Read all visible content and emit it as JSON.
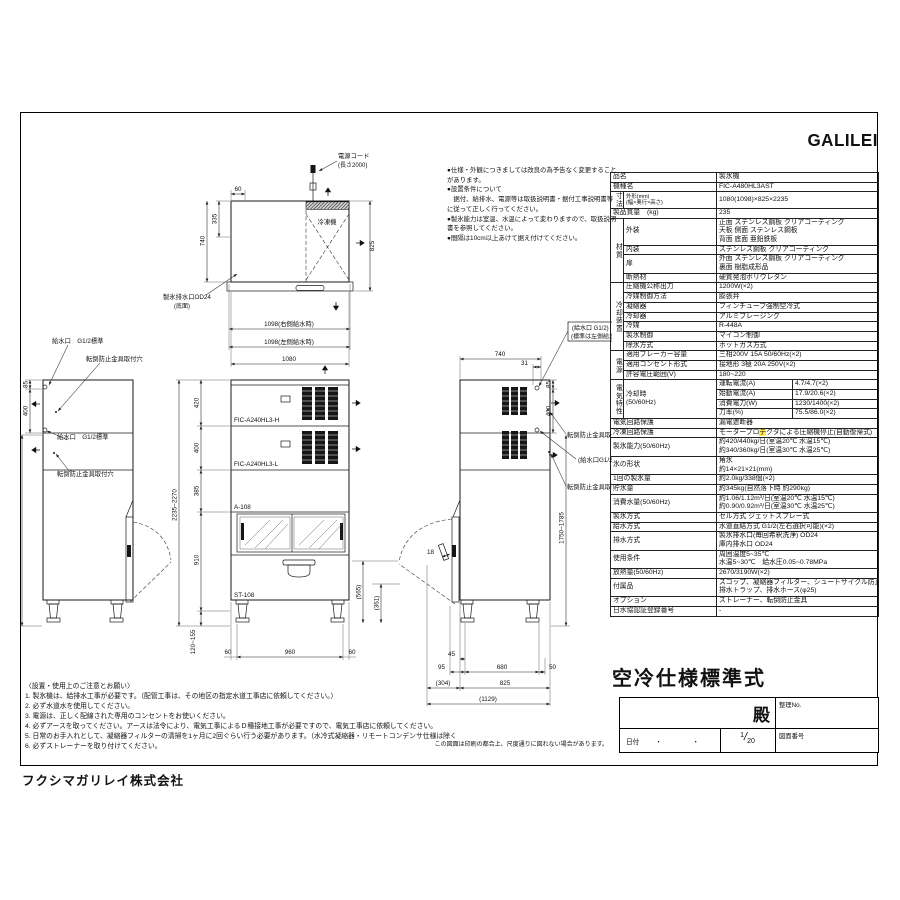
{
  "page": {
    "brand": "GALILEI",
    "company": "フクシマガリレイ株式会社",
    "print_note": "この図面は印刷の都合上、尺度通りに図れない場合があります。"
  },
  "top_notes": {
    "lines": [
      "●仕様・外観につきましては改良の為予告なく変更することがあります。",
      "●設置条件について",
      "　据付、給排水、電源等は取扱説明書・据付工事説明書等に従って正しく行ってください。",
      "●製氷能力は室温、水温によって変わりますので、取扱説明書を参照してください。",
      "●間隔は10cm以上あけて据え付けてください。"
    ]
  },
  "bottom_notes": {
    "title": "〈設置・使用上のご注意とお願い〉",
    "lines": [
      "1. 製氷機は、給排水工事が必要です。（配管工事は、その地区の指定水道工事店に依頼してください。）",
      "2. 必ず水道水を使用してください。",
      "3. 電源は、正しく配線された専用のコンセントをお使いください。",
      "4. 必ずアースを取ってください。アースは法令により、電気工事によるＤ種接地工事が必要ですので、電気工事店に依頼してください。",
      "5. 日常のお手入れとして、凝縮器フィルターの清掃を1ヶ月に2回ぐらい行う必要があります。（水冷式凝縮器・リモートコンデンサ仕様は除く",
      "6. 必ずストレーナーを取り付けてください。"
    ]
  },
  "title_block": {
    "spec_title": "空冷仕様標準式",
    "dono": "殿",
    "seiri_label": "整理No.",
    "date_label": "日付",
    "date_dots": "・　・",
    "scale_num": "1",
    "scale_den": "20",
    "drawing_no_label": "図面番号"
  },
  "drawing": {
    "power_cord": {
      "l1": "電源コード",
      "l2": "(長さ2000)"
    },
    "plan": {
      "refrigerator": "冷凍機",
      "drain1": "製氷排水口OD24",
      "drain2": "(底面)",
      "dims": {
        "d60": "60",
        "d335": "335",
        "d740": "740",
        "d825": "825",
        "w_right": "1098(右側給水時)",
        "w_left": "1098(左側給水時)",
        "w_body": "1080"
      }
    },
    "left_view": {
      "labels": [
        "給水口　G1/2標準",
        "転倒防止金具取付穴",
        "給水口　G1/2標準",
        "転倒防止金具取付穴"
      ],
      "dims": {
        "d85": "85",
        "d400": "400",
        "height": "1750~1785"
      }
    },
    "front": {
      "models": [
        "FIC-A240HL3-H",
        "FIC-A240HL3-L",
        "A-108",
        "ST-108"
      ],
      "dims": {
        "d420": "420",
        "d400": "400",
        "d385": "385",
        "d910": "910",
        "total": "2235~2270",
        "legs": "120~155",
        "d60l": "60",
        "d960": "960",
        "d60r": "60",
        "d565": "(565)",
        "d361": "(361)"
      }
    },
    "right_view": {
      "labels": [
        "(給水口 G1/2)",
        "(標準は左側給水)",
        "転倒防止金具取付穴",
        "(給水口G1/2)",
        "転倒防止金具取付穴"
      ],
      "dims": {
        "d740": "740",
        "d31": "31",
        "d85": "85",
        "d400": "400",
        "height": "1750~1785",
        "d18": "18",
        "d45": "45",
        "d95": "95",
        "d680": "680",
        "d50": "50",
        "d304": "(304)",
        "d825": "825",
        "d1129": "(1129)"
      }
    }
  },
  "spec_table": {
    "rows": [
      {
        "label": "品名",
        "wide": true,
        "value": [
          "製氷機"
        ]
      },
      {
        "label": "機種名",
        "wide": true,
        "value": [
          "FIC-A480HL3AST"
        ]
      },
      {
        "group": {
          "text": "寸法",
          "span": 1
        },
        "label": "外形(mm)\n(幅×奥行×高さ)",
        "small": true,
        "value": [
          "1080(1098)×825×2235"
        ]
      },
      {
        "label": "製品質量　(kg)",
        "wide": true,
        "value": [
          "235"
        ]
      },
      {
        "group": {
          "text": "材質",
          "span": 4
        },
        "label": "外装",
        "value": [
          "正面 ステンレス鋼板 クリアコーティング",
          "天板 側面 ステンレス鋼板",
          "背面 底面 亜鉛鉄板"
        ]
      },
      {
        "label": "内装",
        "value": [
          "ステンレス鋼板 クリアコーティング"
        ]
      },
      {
        "label": "扉",
        "value": [
          "外面 ステンレス鋼板 クリアコーティング",
          "裏面 樹脂成形品"
        ]
      },
      {
        "label": "断熱材",
        "value": [
          "硬質発泡ポリウレタン"
        ]
      },
      {
        "group": {
          "text": "冷却装置",
          "span": 7
        },
        "label": "圧縮機公称出力",
        "value": [
          "1200W(×2)"
        ]
      },
      {
        "label": "冷媒制御方法",
        "value": [
          "膨張弁"
        ]
      },
      {
        "label": "凝縮器",
        "value": [
          "フィンチューブ強制空冷式"
        ]
      },
      {
        "label": "冷却器",
        "value": [
          "アルミブレージング"
        ]
      },
      {
        "label": "冷媒",
        "value": [
          "R-448A"
        ]
      },
      {
        "label": "製氷制御",
        "value": [
          "マイコン制御"
        ]
      },
      {
        "label": "除氷方式",
        "value": [
          "ホットガス方式"
        ]
      },
      {
        "group": {
          "text": "電源",
          "span": 3
        },
        "label": "適用ブレーカー容量",
        "value": [
          "三相200V 15A 50/60Hz(×2)"
        ]
      },
      {
        "label": "適用コンセント形式",
        "value": [
          "接地形 3極 20A 250V(×2)"
        ]
      },
      {
        "label": "許容電圧範囲(V)",
        "value": [
          "180~220"
        ]
      },
      {
        "group": {
          "text": "電気特性",
          "span": 4
        },
        "label": "冷却時\n(50/60Hz)",
        "labelspan": 4,
        "sub": {
          "name": "運転電流(A)",
          "val": "4.7/4.7(×2)"
        }
      },
      {
        "sub": {
          "name": "始動電流(A)",
          "val": "17.9/20.6(×2)"
        }
      },
      {
        "sub": {
          "name": "消費電力(W)",
          "val": "1230/1400(×2)"
        }
      },
      {
        "sub": {
          "name": "力率(%)",
          "val": "75.5/86.0(×2)"
        }
      },
      {
        "label": "電気回路保護",
        "wide": true,
        "value": [
          "漏電遮断器"
        ]
      },
      {
        "label": "冷凍回路保護",
        "wide": true,
        "value": [
          {
            "pre": "モータープロ",
            "hl": "テ",
            "post": "クタによる圧縮機停止(自動復帰式)"
          }
        ]
      },
      {
        "label": "製氷能力(50/60Hz)",
        "wide": true,
        "value": [
          "約420/440kg/日(室温20℃ 水温15℃)",
          "約340/360kg/日(室温30℃ 水温25℃)"
        ]
      },
      {
        "label": "氷の形状",
        "wide": true,
        "value": [
          "角氷",
          "約14×21×21(mm)"
        ]
      },
      {
        "label": "1回の製氷量",
        "wide": true,
        "value": [
          "約2.0kg/338個(×2)"
        ]
      },
      {
        "label": "貯氷量",
        "wide": true,
        "value": [
          "約345kg(自然落下時 約290kg)"
        ]
      },
      {
        "label": "消費水量(50/60Hz)",
        "wide": true,
        "value": [
          "約1.06/1.12m³/日(室温20℃ 水温15℃)",
          "約0.90/0.92m³/日(室温30℃ 水温25℃)"
        ]
      },
      {
        "label": "製氷方式",
        "wide": true,
        "value": [
          "セル方式 ジェットスプレー式"
        ]
      },
      {
        "label": "給水方式",
        "wide": true,
        "value": [
          "水道直結方式 G1/2(左右選択可能)(×2)"
        ]
      },
      {
        "label": "排水方式",
        "wide": true,
        "value": [
          "製氷排水口(毎回希釈洗浄) OD24",
          "庫内排水口 OD24"
        ]
      },
      {
        "label": "使用条件",
        "wide": true,
        "value": [
          "周囲温度5~35℃",
          "水温5~30℃　給水圧0.05~0.78MPa"
        ]
      },
      {
        "label": "放熱量(50/60Hz)",
        "wide": true,
        "value": [
          "2670/3190W(×2)"
        ]
      },
      {
        "label": "付属品",
        "wide": true,
        "value": [
          "スコップ、凝縮器フィルター、シュートサイクル防止板",
          "排水トラップ、排水ホース(φ25)"
        ]
      },
      {
        "label": "オプション",
        "wide": true,
        "value": [
          "ストレーナー、転倒防止金具"
        ]
      },
      {
        "label": "日水協認証登録番号",
        "wide": true,
        "value": [
          "-"
        ]
      }
    ]
  }
}
